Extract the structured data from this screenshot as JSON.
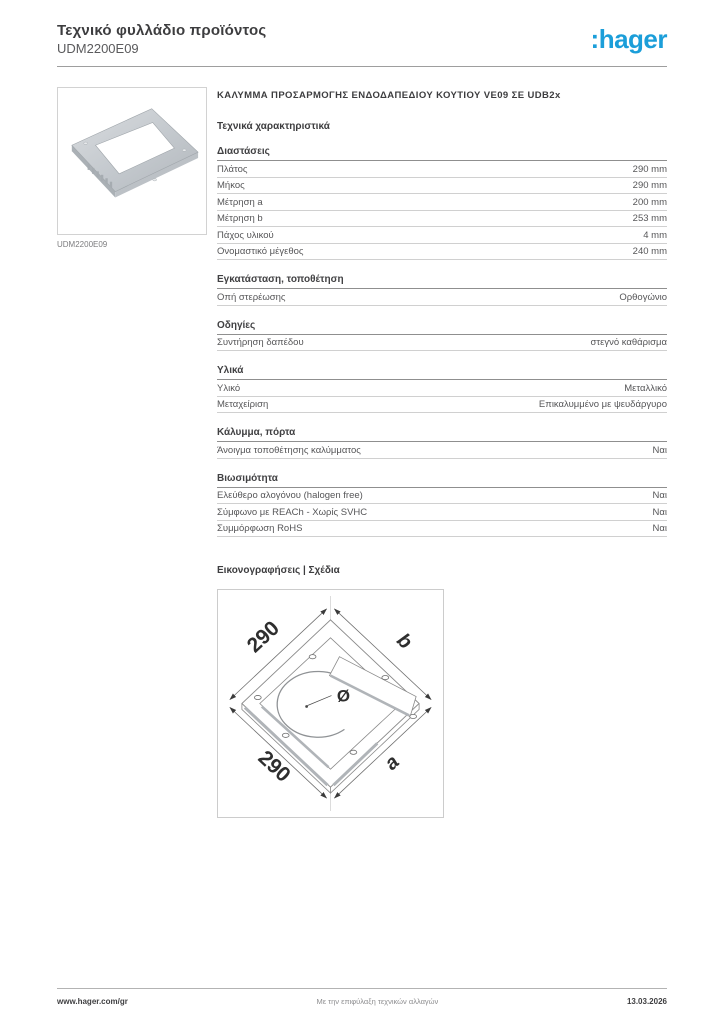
{
  "page": {
    "title": "Τεχνικό φυλλάδιο προϊόντος",
    "reference": "UDM2200E09"
  },
  "brand": {
    "logo_text": ":hager",
    "color": "#1b9ed9"
  },
  "product": {
    "image_caption": "UDM2200E09",
    "heading": "ΚΑΛΥΜΜΑ ΠΡΟΣΑΡΜΟΓΗΣ ΕΝΔΟΔΑΠΕΔΙΟΥ ΚΟΥΤΙΟΥ VE09 ΣΕ UDB2x"
  },
  "specs": {
    "title": "Τεχνικά χαρακτηριστικά",
    "sections": [
      {
        "heading": "Διαστάσεις",
        "rows": [
          {
            "label": "Πλάτος",
            "value": "290 mm"
          },
          {
            "label": "Μήκος",
            "value": "290 mm"
          },
          {
            "label": "Μέτρηση a",
            "value": "200 mm"
          },
          {
            "label": "Μέτρηση b",
            "value": "253 mm"
          },
          {
            "label": "Πάχος υλικού",
            "value": "4 mm"
          },
          {
            "label": "Ονομαστικό μέγεθος",
            "value": "240 mm"
          }
        ]
      },
      {
        "heading": "Εγκατάσταση, τοποθέτηση",
        "rows": [
          {
            "label": "Οπή στερέωσης",
            "value": "Ορθογώνιο"
          }
        ]
      },
      {
        "heading": "Οδηγίες",
        "rows": [
          {
            "label": "Συντήρηση δαπέδου",
            "value": "στεγνό καθάρισμα"
          }
        ]
      },
      {
        "heading": "Υλικά",
        "rows": [
          {
            "label": "Υλικό",
            "value": "Μεταλλικό"
          },
          {
            "label": "Μεταχείριση",
            "value": "Επικαλυμμένο με ψευδάργυρο"
          }
        ]
      },
      {
        "heading": "Κάλυμμα, πόρτα",
        "rows": [
          {
            "label": "Άνοιγμα τοποθέτησης καλύμματος",
            "value": "Ναι"
          }
        ]
      },
      {
        "heading": "Βιωσιμότητα",
        "rows": [
          {
            "label": "Ελεύθερο αλογόνου (halogen free)",
            "value": "Ναι"
          },
          {
            "label": "Σύμφωνο με REACh - Χωρίς SVHC",
            "value": "Ναι"
          },
          {
            "label": "Συμμόρφωση RoHS",
            "value": "Ναι"
          }
        ]
      }
    ]
  },
  "illustrations": {
    "title": "Εικονογραφήσεις | Σχέδια",
    "drawing": {
      "dim_top_left": "290",
      "dim_top_right": "b",
      "dim_bottom_left": "290",
      "dim_bottom_right": "a",
      "diameter_symbol": "Ø"
    }
  },
  "footer": {
    "website": "www.hager.com/gr",
    "disclaimer": "Με την επιφύλαξη τεχνικών αλλαγών",
    "date": "13.03.2026"
  }
}
